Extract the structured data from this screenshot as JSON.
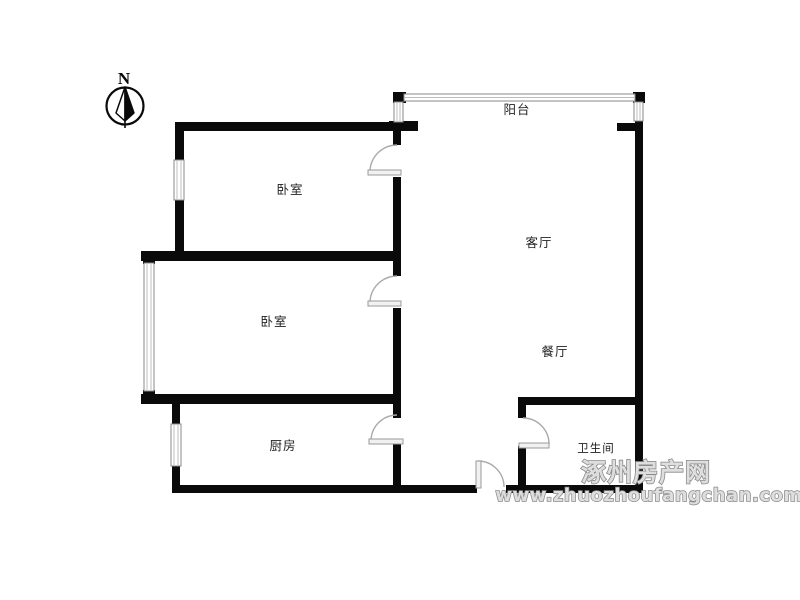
{
  "compass": {
    "north_label": "N"
  },
  "rooms": {
    "balcony": "阳台",
    "bedroom1": "卧室",
    "bedroom2": "卧室",
    "living": "客厅",
    "dining": "餐厅",
    "kitchen": "厨房",
    "bathroom": "卫生间"
  },
  "watermark": {
    "site_name": "涿州房产网",
    "site_url": "www.zhuozhoufangchan.com",
    "color": "#8a8a8a"
  },
  "colors": {
    "background": "#ffffff",
    "wall": "#0a0a0a",
    "door_arc": "#aaaaaa",
    "window_border": "#8a8a8a",
    "label_text": "#1f1f1f",
    "watermark_fill": "#dedede"
  }
}
